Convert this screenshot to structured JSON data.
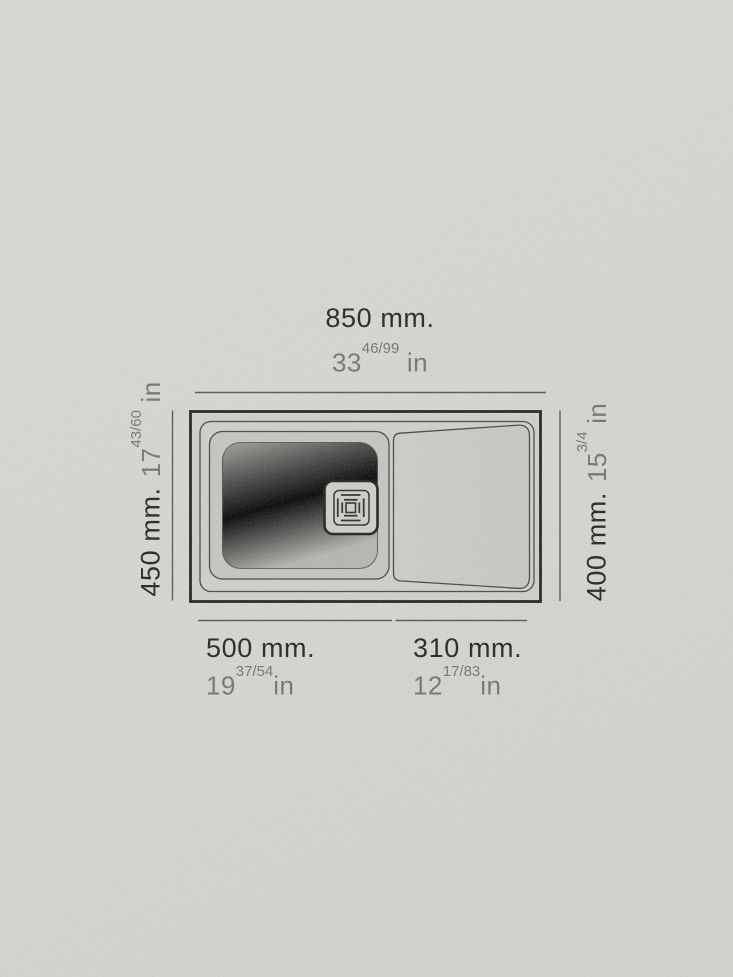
{
  "diagram": {
    "subject": "kitchen-sink-top-view-dimension-drawing",
    "colors": {
      "paper": "#d8d7d2",
      "outline_ink": "#1d1c1a",
      "thin_line": "#45433f",
      "dimension_line": "#55534f",
      "text_dark": "#21201e",
      "text_gray": "#73726d",
      "bowl_fill": "#aaa9a5",
      "deck_fill": "#d1d0cb",
      "drainboard_fill": "#cccbc6"
    },
    "dimensions": {
      "overall_width": {
        "mm_label": "850 mm.",
        "inches_whole": "33",
        "inches_fraction": "46/99",
        "inches_unit": " in"
      },
      "overall_depth": {
        "mm_label": "450 mm.",
        "inches_whole": "17",
        "inches_fraction": "43/60",
        "inches_unit": " in"
      },
      "inner_depth": {
        "mm_label": "400 mm.",
        "inches_whole": "15",
        "inches_fraction": "3/4",
        "inches_unit": " in"
      },
      "bowl_width": {
        "mm_label": "500 mm.",
        "inches_whole": "19",
        "inches_fraction": "37/54",
        "inches_unit": "in"
      },
      "drainboard_width": {
        "mm_label": "310 mm.",
        "inches_whole": "12",
        "inches_fraction": "17/83",
        "inches_unit": "in"
      }
    }
  }
}
